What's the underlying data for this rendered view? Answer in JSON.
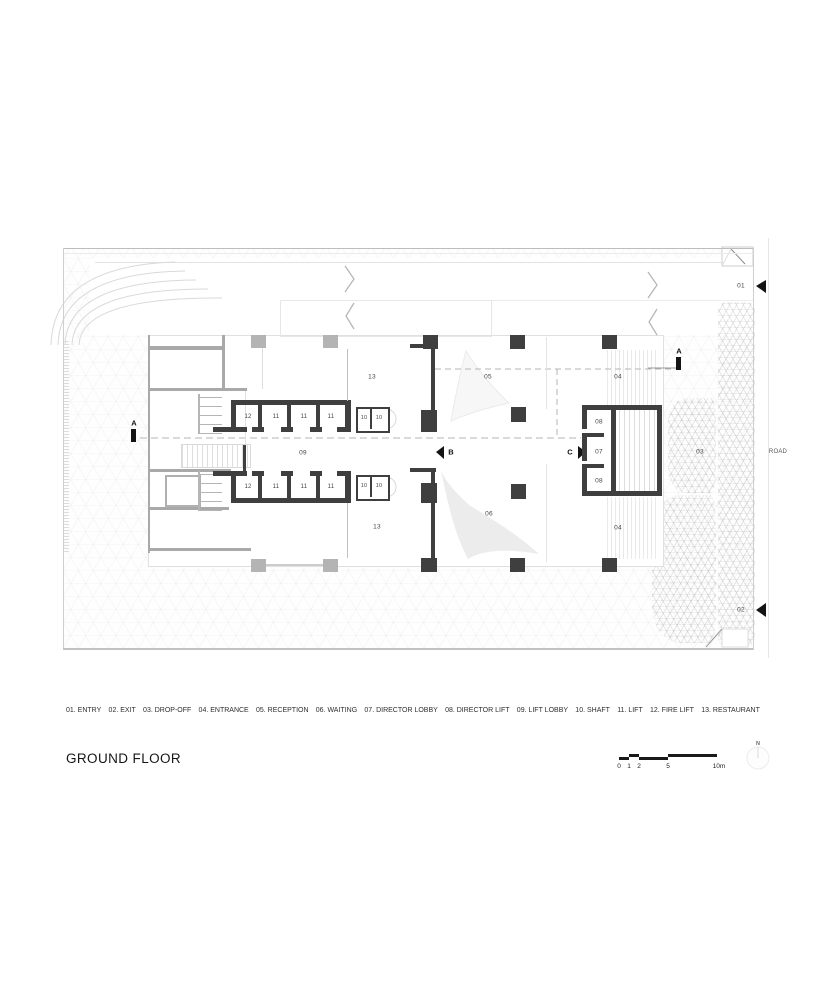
{
  "title": "GROUND FLOOR",
  "legend": {
    "items": [
      "01. ENTRY",
      "02. EXIT",
      "03. DROP-OFF",
      "04. ENTRANCE",
      "05. RECEPTION",
      "06. WAITING",
      "07. DIRECTOR LOBBY",
      "08. DIRECTOR LIFT",
      "09. LIFT LOBBY",
      "10. SHAFT",
      "11. LIFT",
      "12. FIRE LIFT",
      "13. RESTAURANT"
    ]
  },
  "scale_bar": {
    "labels": [
      "0",
      "1",
      "2",
      "5",
      "10m"
    ]
  },
  "compass": {
    "label": "N"
  },
  "plan": {
    "road_label": "ROAD",
    "rooms": {
      "entry": "01",
      "exit": "02",
      "drop_off": "03",
      "entrance": "04",
      "reception": "05",
      "waiting": "06",
      "director_lobby": "07",
      "director_lift": "08",
      "lift_lobby": "09",
      "shaft": "10",
      "lift": "11",
      "fire_lift": "12",
      "restaurant": "13"
    },
    "sections": {
      "a": "A",
      "b": "B",
      "c": "C"
    }
  },
  "colors": {
    "wall_dark": "#3f3f3f",
    "marker_black": "#141414",
    "site_line": "#c8c8c8"
  }
}
